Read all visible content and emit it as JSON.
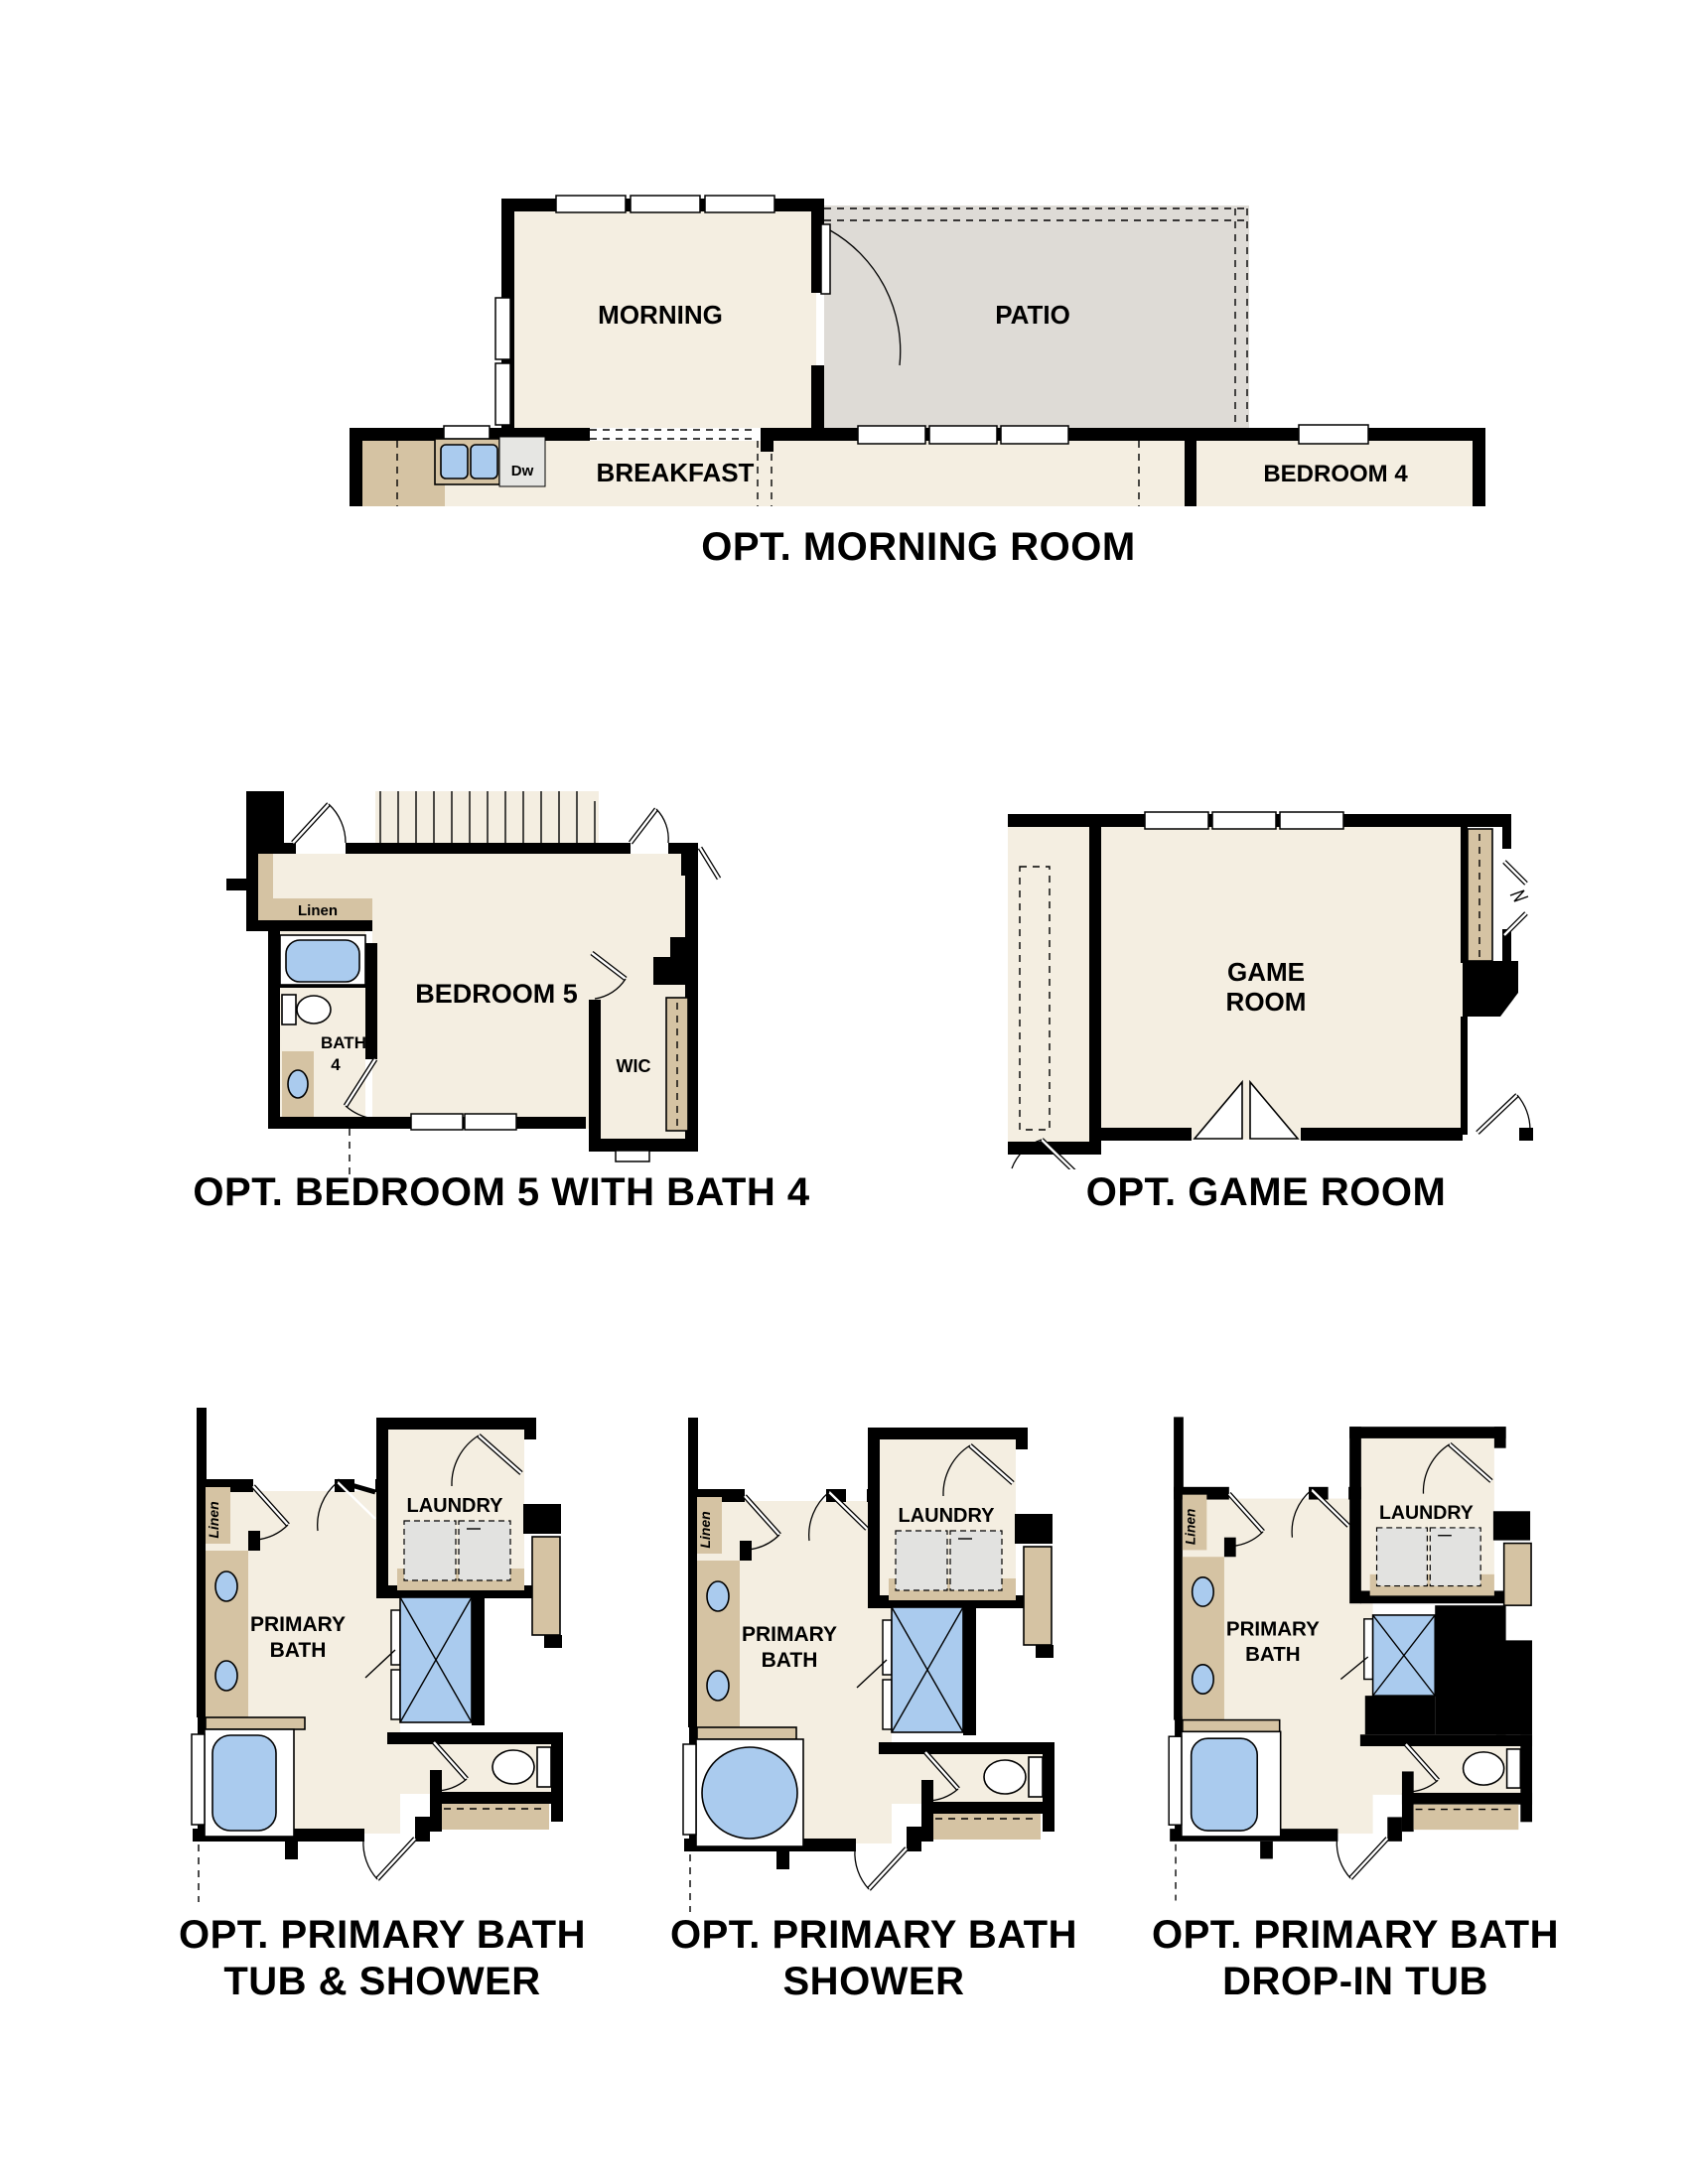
{
  "colors": {
    "wall": "#000000",
    "room": "#f4eee1",
    "patio": "#dedbd6",
    "tan": "#d5c3a3",
    "blue": "#aacbee",
    "gray": "#e2e2e0",
    "white": "#ffffff"
  },
  "plans": {
    "morning": {
      "caption": "OPT. MORNING ROOM",
      "room": "MORNING",
      "patio": "PATIO",
      "breakfast": "BREAKFAST",
      "bedroom4": "BEDROOM 4",
      "dishwasher": "Dw"
    },
    "bedroom5": {
      "caption": "OPT. BEDROOM 5 WITH BATH 4",
      "room": "BEDROOM 5",
      "bath_line1": "BATH",
      "bath_line2": "4",
      "wic": "WIC",
      "linen": "Linen"
    },
    "gameroom": {
      "caption": "OPT. GAME ROOM",
      "line1": "GAME",
      "line2": "ROOM"
    },
    "bath_tub_shower": {
      "caption_line1": "OPT. PRIMARY BATH",
      "caption_line2": "TUB & SHOWER",
      "room_line1": "PRIMARY",
      "room_line2": "BATH",
      "laundry": "LAUNDRY",
      "linen": "Linen"
    },
    "bath_shower": {
      "caption_line1": "OPT. PRIMARY BATH",
      "caption_line2": "SHOWER",
      "room_line1": "PRIMARY",
      "room_line2": "BATH",
      "laundry": "LAUNDRY",
      "linen": "Linen"
    },
    "bath_dropin": {
      "caption_line1": "OPT. PRIMARY BATH",
      "caption_line2": "DROP-IN TUB",
      "room_line1": "PRIMARY",
      "room_line2": "BATH",
      "laundry": "LAUNDRY",
      "linen": "Linen"
    }
  }
}
